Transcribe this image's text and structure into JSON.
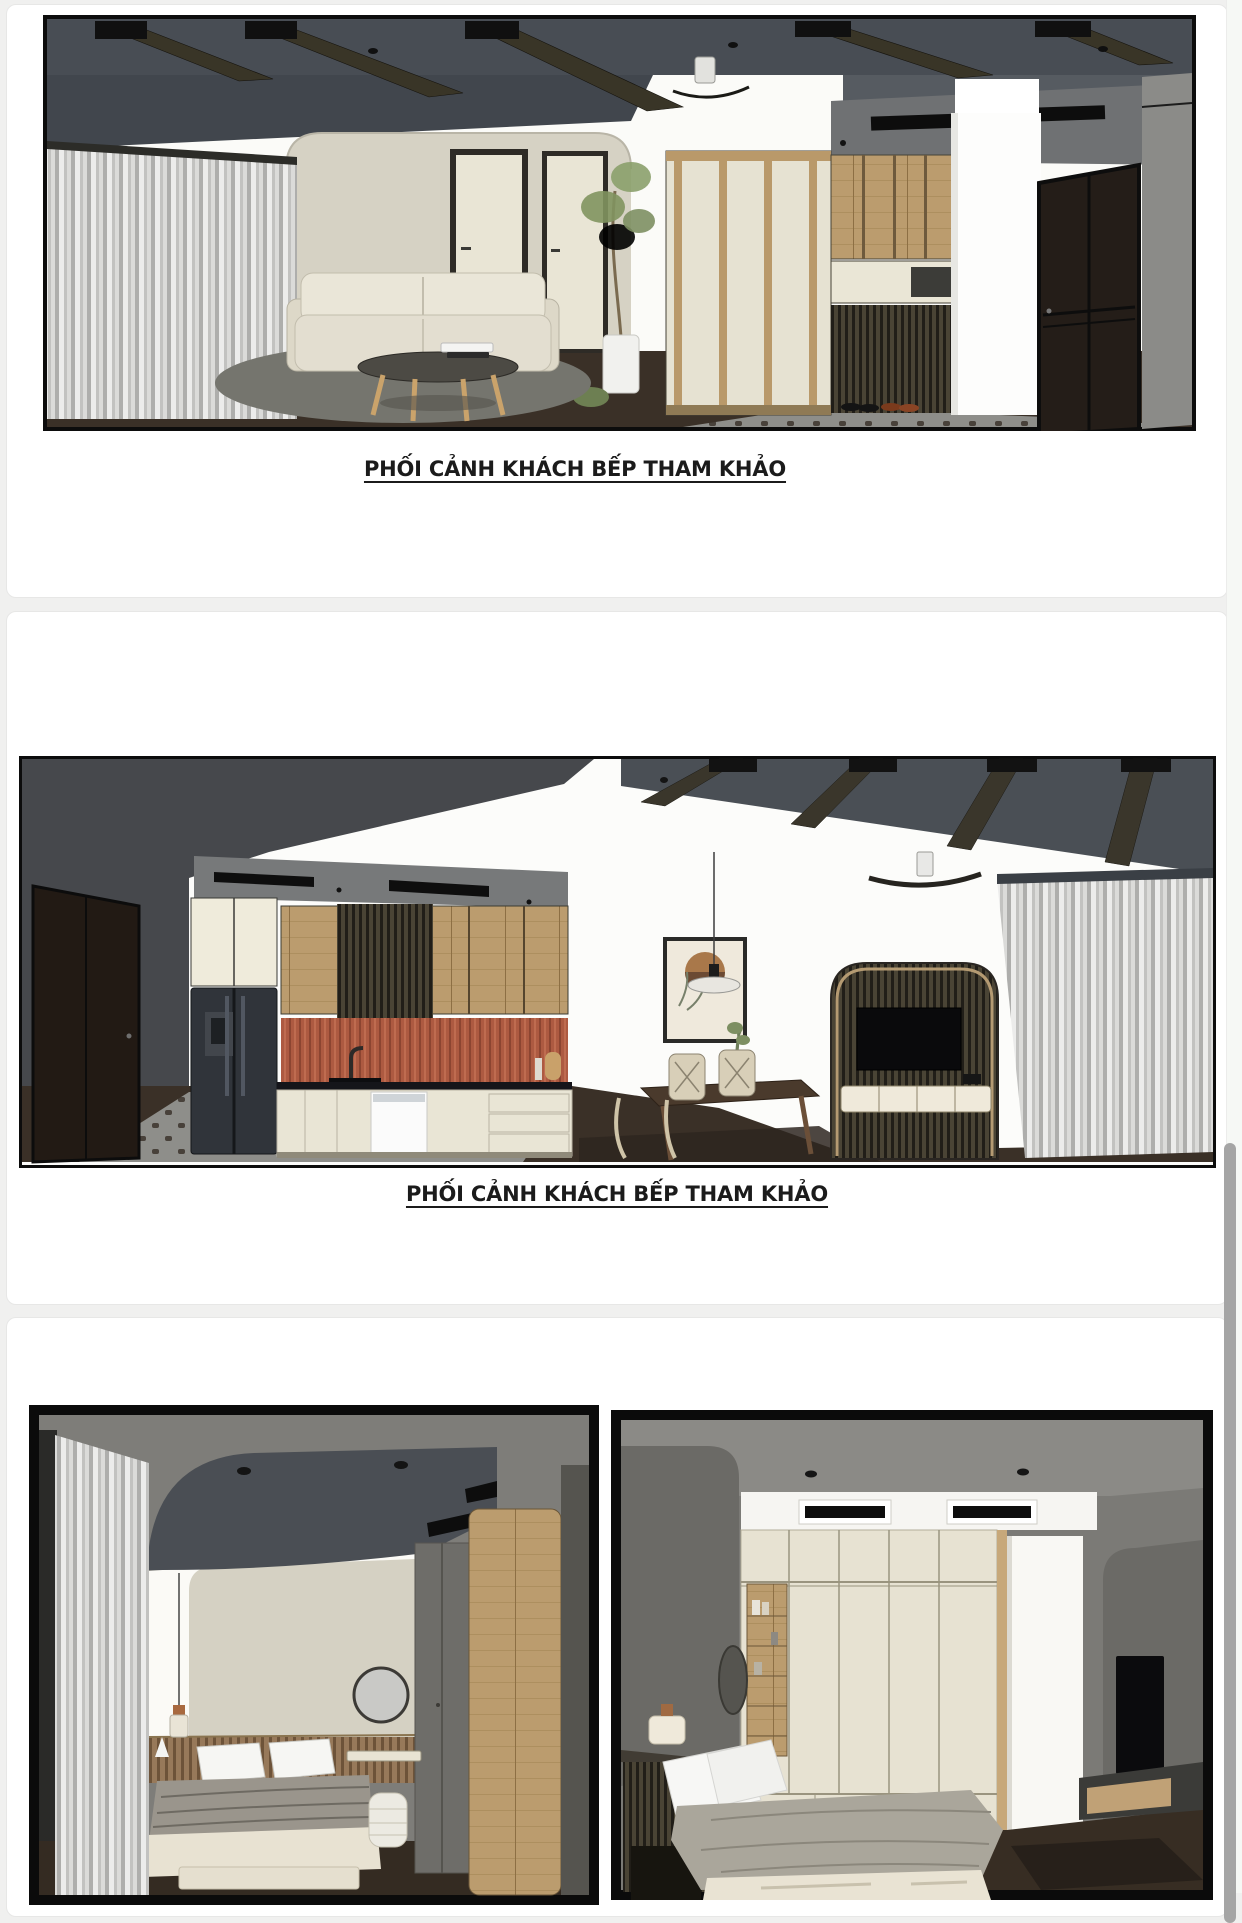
{
  "document": {
    "pages": [
      {
        "caption": "PHỐI CẢNH KHÁCH BẾP THAM KHẢO",
        "figure": "living-room-sofa-entry-render"
      },
      {
        "caption": "PHỐI CẢNH KHÁCH BẾP THAM KHẢO",
        "figure": "kitchen-dining-tv-render"
      },
      {
        "figures": [
          "bedroom-dressing-render",
          "bedroom-wardrobe-tv-render"
        ]
      }
    ]
  },
  "scrollbar": {
    "thumb_visible": true
  },
  "colors": {
    "page_background": "#f0f0ef",
    "panel": "#ffffff",
    "caption_text": "#1b1b1b",
    "scrollbar_thumb": "#a5a5a5",
    "render_ceiling": "#4a4f55",
    "render_wall_gray": "#7e7d79",
    "render_cream": "#e8e4d4",
    "render_wood": "#bb9c6e",
    "render_terracotta": "#ad5a41",
    "render_floor": "#3a3027"
  }
}
